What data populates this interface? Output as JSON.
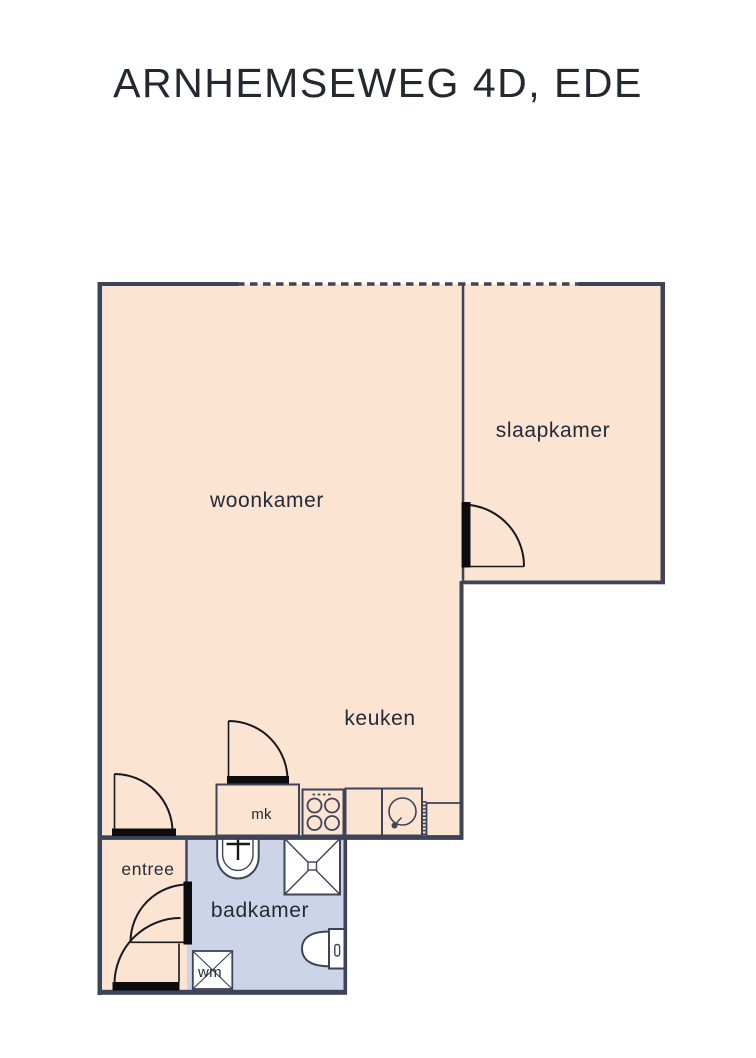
{
  "title": "ARNHEMSEWEG 4D, EDE",
  "rooms": {
    "woonkamer": "woonkamer",
    "slaapkamer": "slaapkamer",
    "keuken": "keuken",
    "badkamer": "badkamer",
    "entree": "entree"
  },
  "closets": {
    "mk": "mk",
    "wm": "wm"
  },
  "fixtures": {
    "kitchen": [
      "meter-closet",
      "stove-icon",
      "counter",
      "sink-icon",
      "radiator-icon",
      "boiler-cabinet"
    ],
    "bathroom": [
      "washbasin-icon",
      "shower-icon",
      "toilet-icon",
      "washing-machine-icon"
    ],
    "doors": [
      "entree-front-door",
      "entree-bathroom-door",
      "livingroom-door",
      "mk-door",
      "bedroom-door"
    ],
    "window_line": "dashed-window-line"
  },
  "colors": {
    "floor_main": "#fce4d3",
    "floor_bathroom": "#ccd5e7",
    "wall": "#3d4458",
    "door": "#0c0c0e",
    "fixture_fill": "#ffffff",
    "basin_fill": "#d7dce3",
    "label_text": "#242a38",
    "title_text": "#24282f"
  }
}
